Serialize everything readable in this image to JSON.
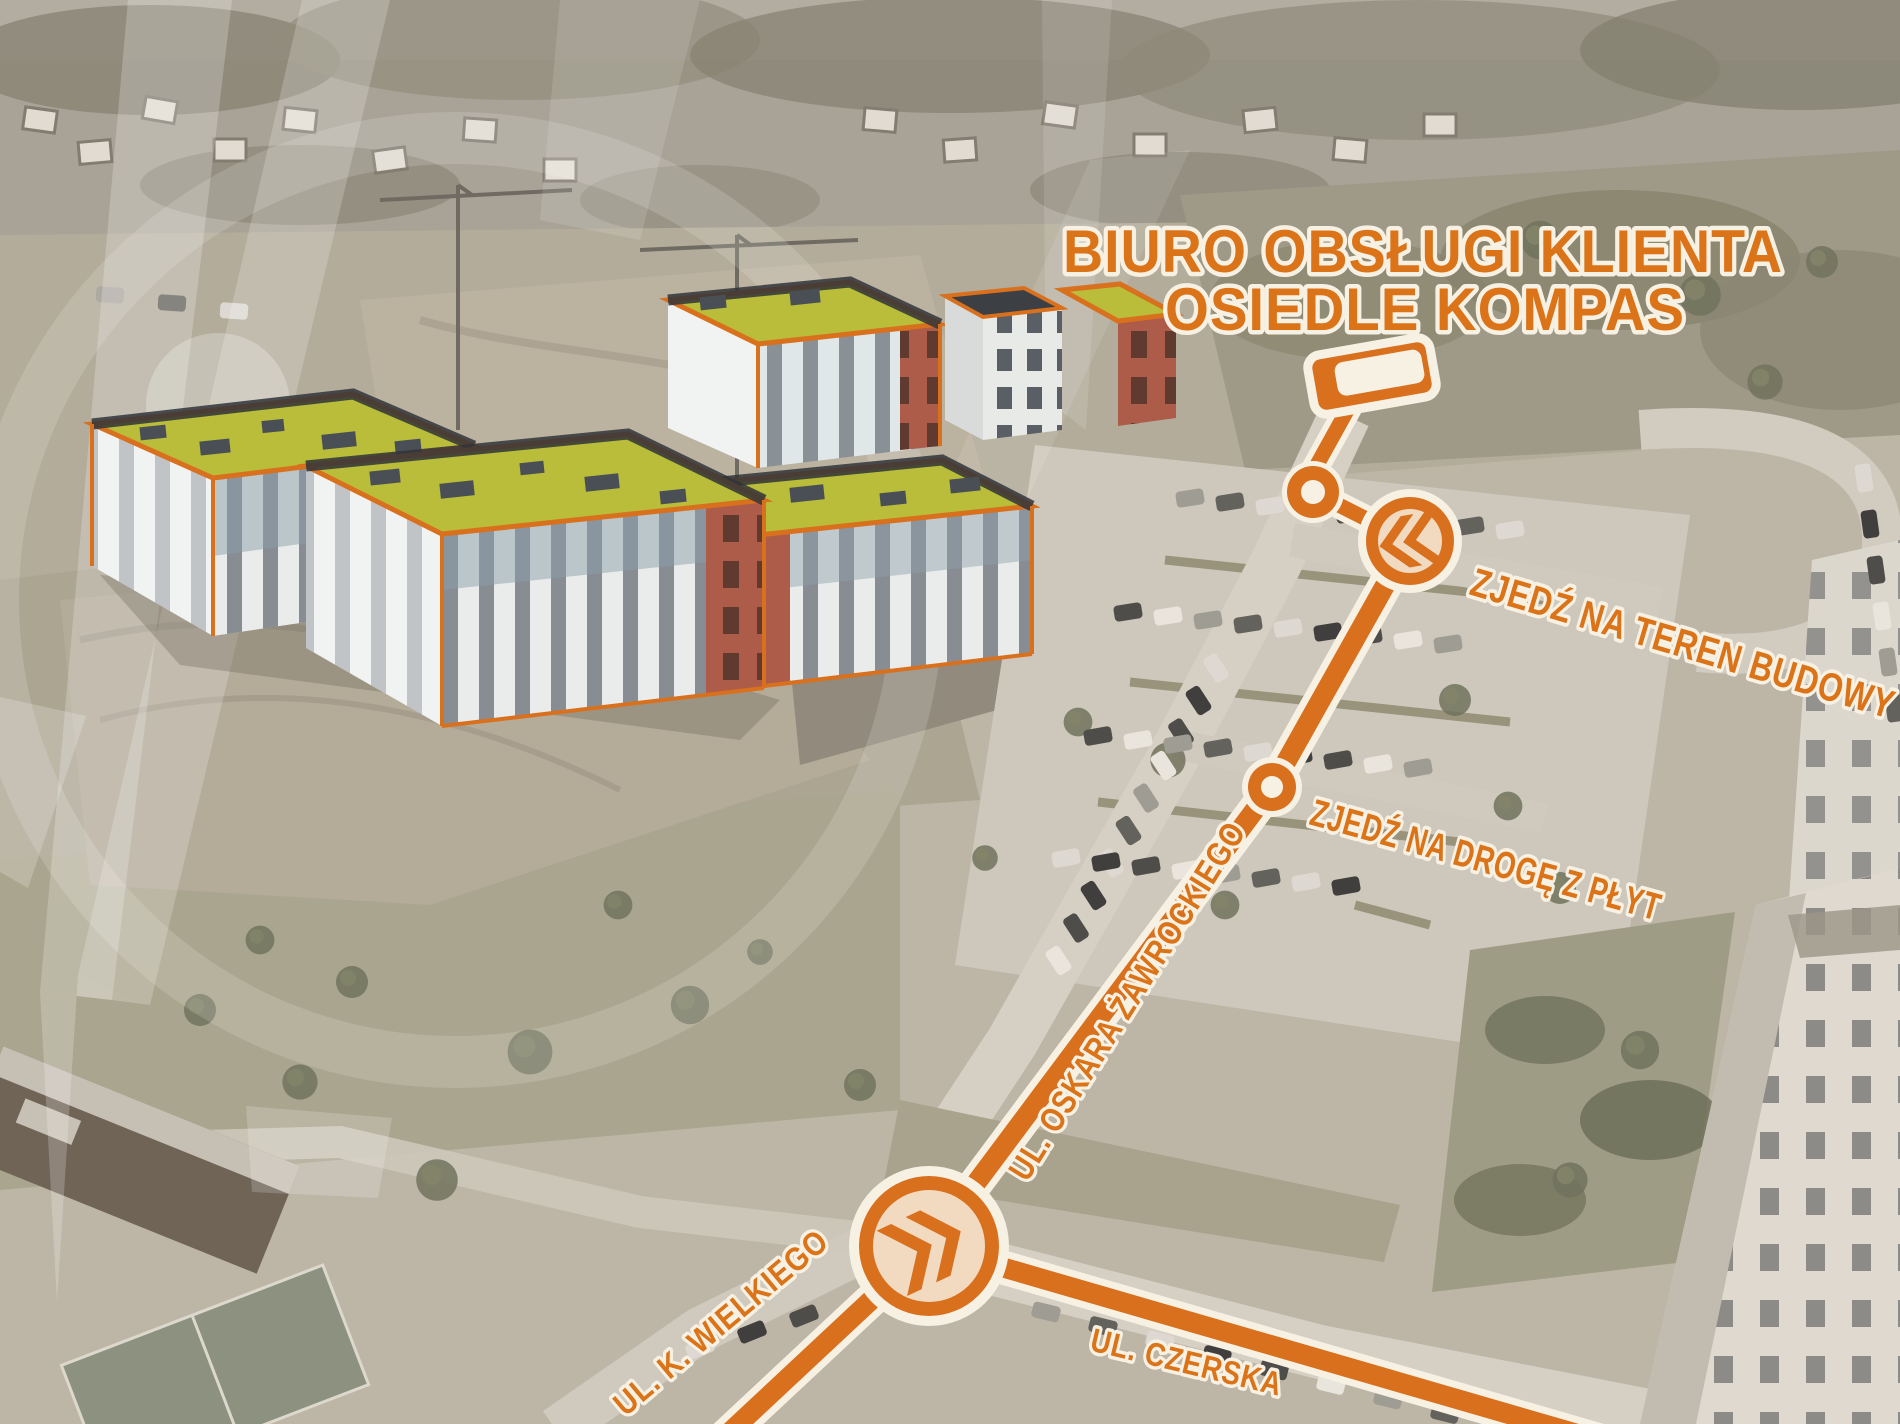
{
  "map": {
    "title_line1": "BIURO OBSŁUGI KLIENTA",
    "title_line2": "OSIEDLE KOMPAS",
    "direction_teren_budowy": "ZJEDŹ NA TEREN BUDOWY",
    "direction_droga_z_plyt": "ZJEDŹ NA DROGĘ Z PŁYT",
    "street_oskara": "UL. OSKARA ŻAWROCKIEGO",
    "street_wielkiego": "UL. K. WIELKIEGO",
    "street_czerska": "UL. CZERSKA"
  },
  "colors": {
    "accent_orange": "#d8701e",
    "label_orange": "#db7318",
    "casing_white": "#f7f1e4",
    "roof_green": "#b9bd3a",
    "brick_red": "#ad5c49",
    "facade_white": "#e9ecea",
    "watermark_white": "#ffffff"
  }
}
